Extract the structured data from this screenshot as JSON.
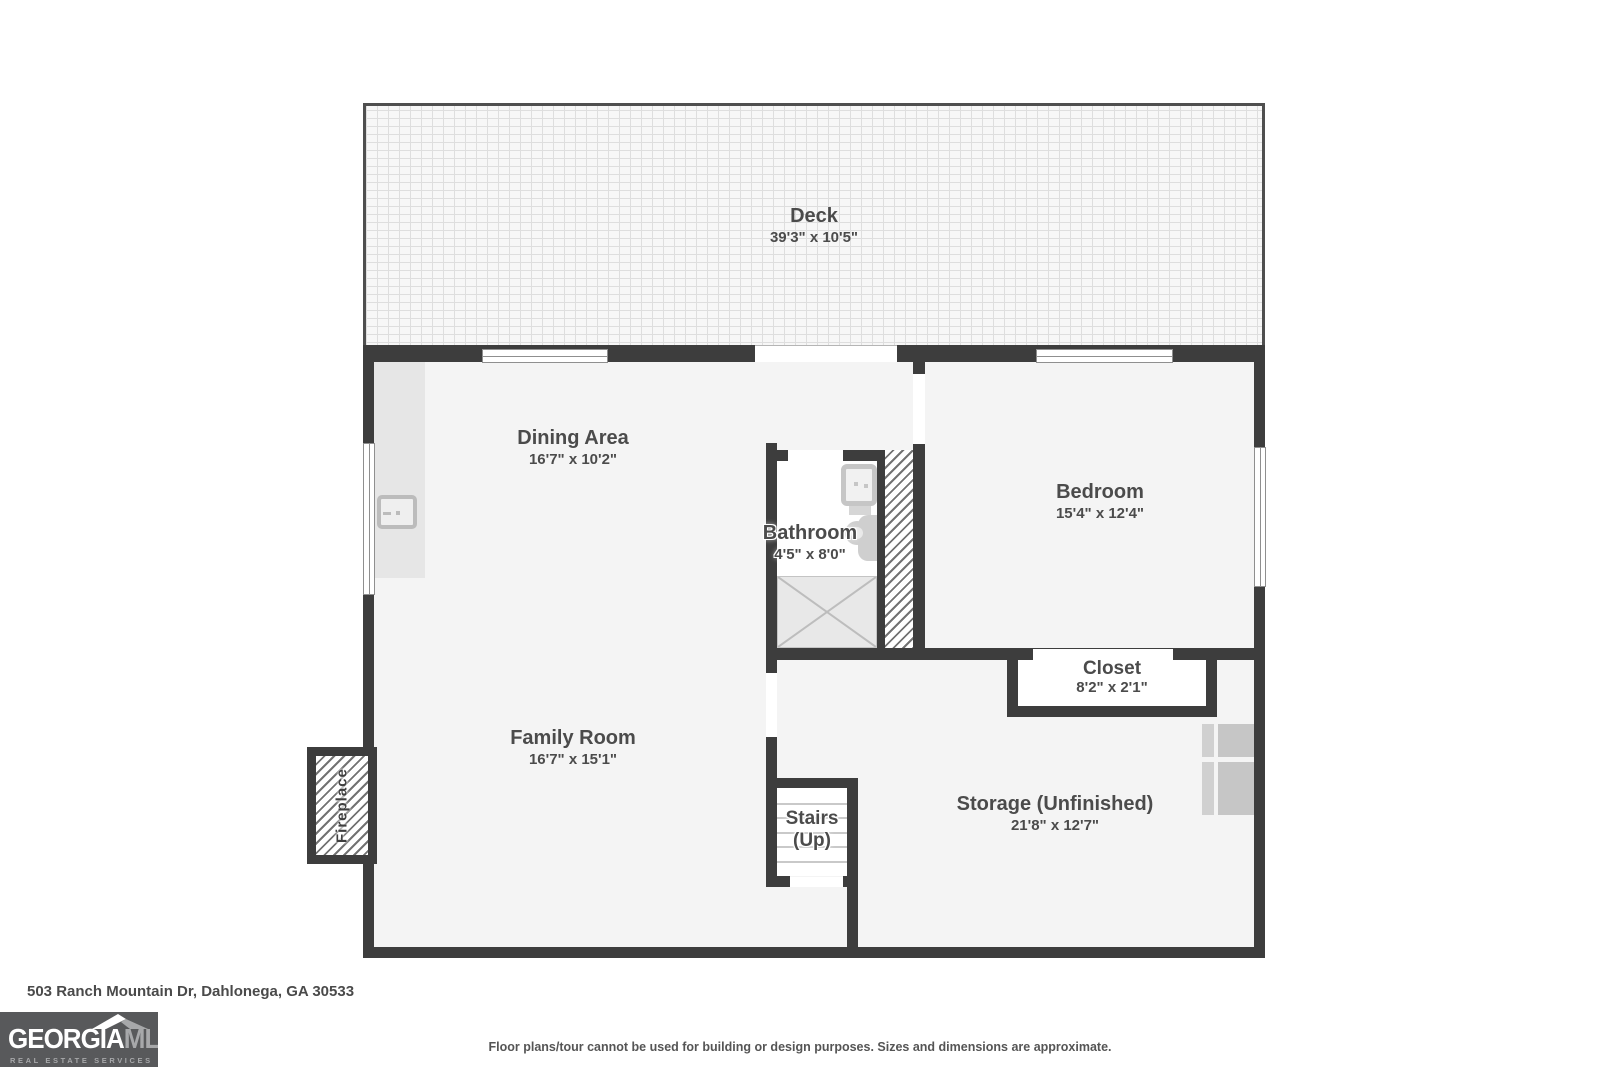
{
  "plan": {
    "palette": {
      "wall": "#3d3d3d",
      "floor": "#f4f4f4",
      "label": "#4b4b4b",
      "logo_bg": "#58595b"
    },
    "rooms": {
      "deck": {
        "name": "Deck",
        "dims": "39'3\" x 10'5\""
      },
      "dining": {
        "name": "Dining Area",
        "dims": "16'7\" x 10'2\""
      },
      "bathroom": {
        "name": "Bathroom",
        "dims": "4'5\" x 8'0\""
      },
      "bedroom": {
        "name": "Bedroom",
        "dims": "15'4\" x 12'4\""
      },
      "closet": {
        "name": "Closet",
        "dims": "8'2\" x 2'1\""
      },
      "family": {
        "name": "Family Room",
        "dims": "16'7\" x 15'1\""
      },
      "storage": {
        "name": "Storage (Unfinished)",
        "dims": "21'8\" x 12'7\""
      },
      "stairs": {
        "name": "Stairs",
        "dims": "(Up)"
      },
      "fireplace": {
        "name": "Fireplace"
      }
    }
  },
  "footer": {
    "address": "503 Ranch Mountain Dr, Dahlonega, GA 30533",
    "disclaimer": "Floor plans/tour cannot be used for building or design purposes. Sizes and dimensions are approximate.",
    "logo": {
      "brand_primary": "GEORGIA",
      "brand_secondary": "MLS",
      "tagline": "REAL ESTATE SERVICES"
    }
  }
}
